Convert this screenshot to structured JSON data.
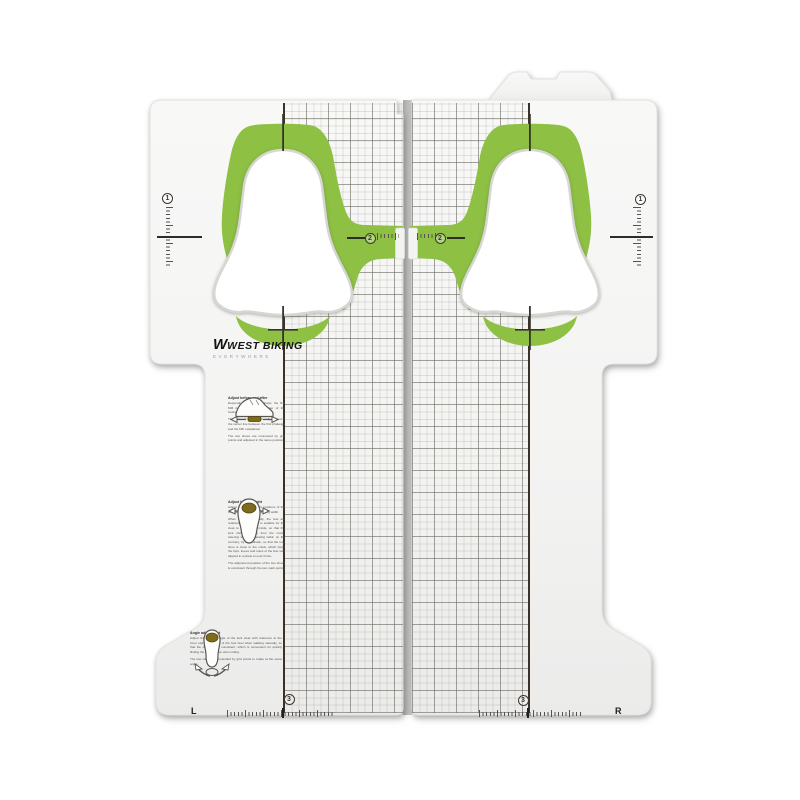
{
  "product": {
    "name": "cleat alignment tool",
    "brand": {
      "name": "WEST BIKING",
      "tagline": "EVERYWHERE"
    },
    "side_labels": {
      "left": "L",
      "right": "R"
    },
    "markers": [
      "1",
      "2",
      "3"
    ],
    "instructions": [
      {
        "icon": "shoe-side-icon",
        "heading": "Adjust before and after",
        "paragraphs": [
          "Depending on the foot shape, the first MM is inserted in the center of the football area.",
          "The center of force is generally located in the center line between the first phalange and the fifth metatarsal.",
          "The two shoes are connected by grid points and adjusted in the same position."
        ]
      },
      {
        "icon": "sole-top-icon",
        "heading": "Adjust left and right",
        "paragraphs": [
          "Adjust the left and right positions of the cleat according to the standing width.",
          "When standing naturally, the feet are relatively separated; it is suitable for the cleat to be installed inside, so that the lock shoe is away from the crank, catering to the separating habit; on the contrary, by the outside, so that the lock shoe is close to the crank, which helps the hips, knees and soles of the feet stay aligned in a plane to exert force.",
          "The adjustment position of the two shoes is consistent through the two mark points."
        ]
      },
      {
        "icon": "sole-front-icon",
        "heading": "Angle adjustment",
        "paragraphs": [
          "Adjust the rotation angle of the lock cleat with reference to the inner eight or parallel of the foot heel when walking naturally, so that the deflection is consistent, which is convenient for quickly finding the lock position when riding.",
          "The two cleats are controlled by grid points to rotate at the same angle."
        ]
      }
    ],
    "colors": {
      "cleat_green": "#8dc043",
      "line_dark": "#38322b",
      "icon_olive": "#7e6c1e",
      "panel_light": "#f7f7f6",
      "panel_dark": "#ececeb"
    }
  }
}
